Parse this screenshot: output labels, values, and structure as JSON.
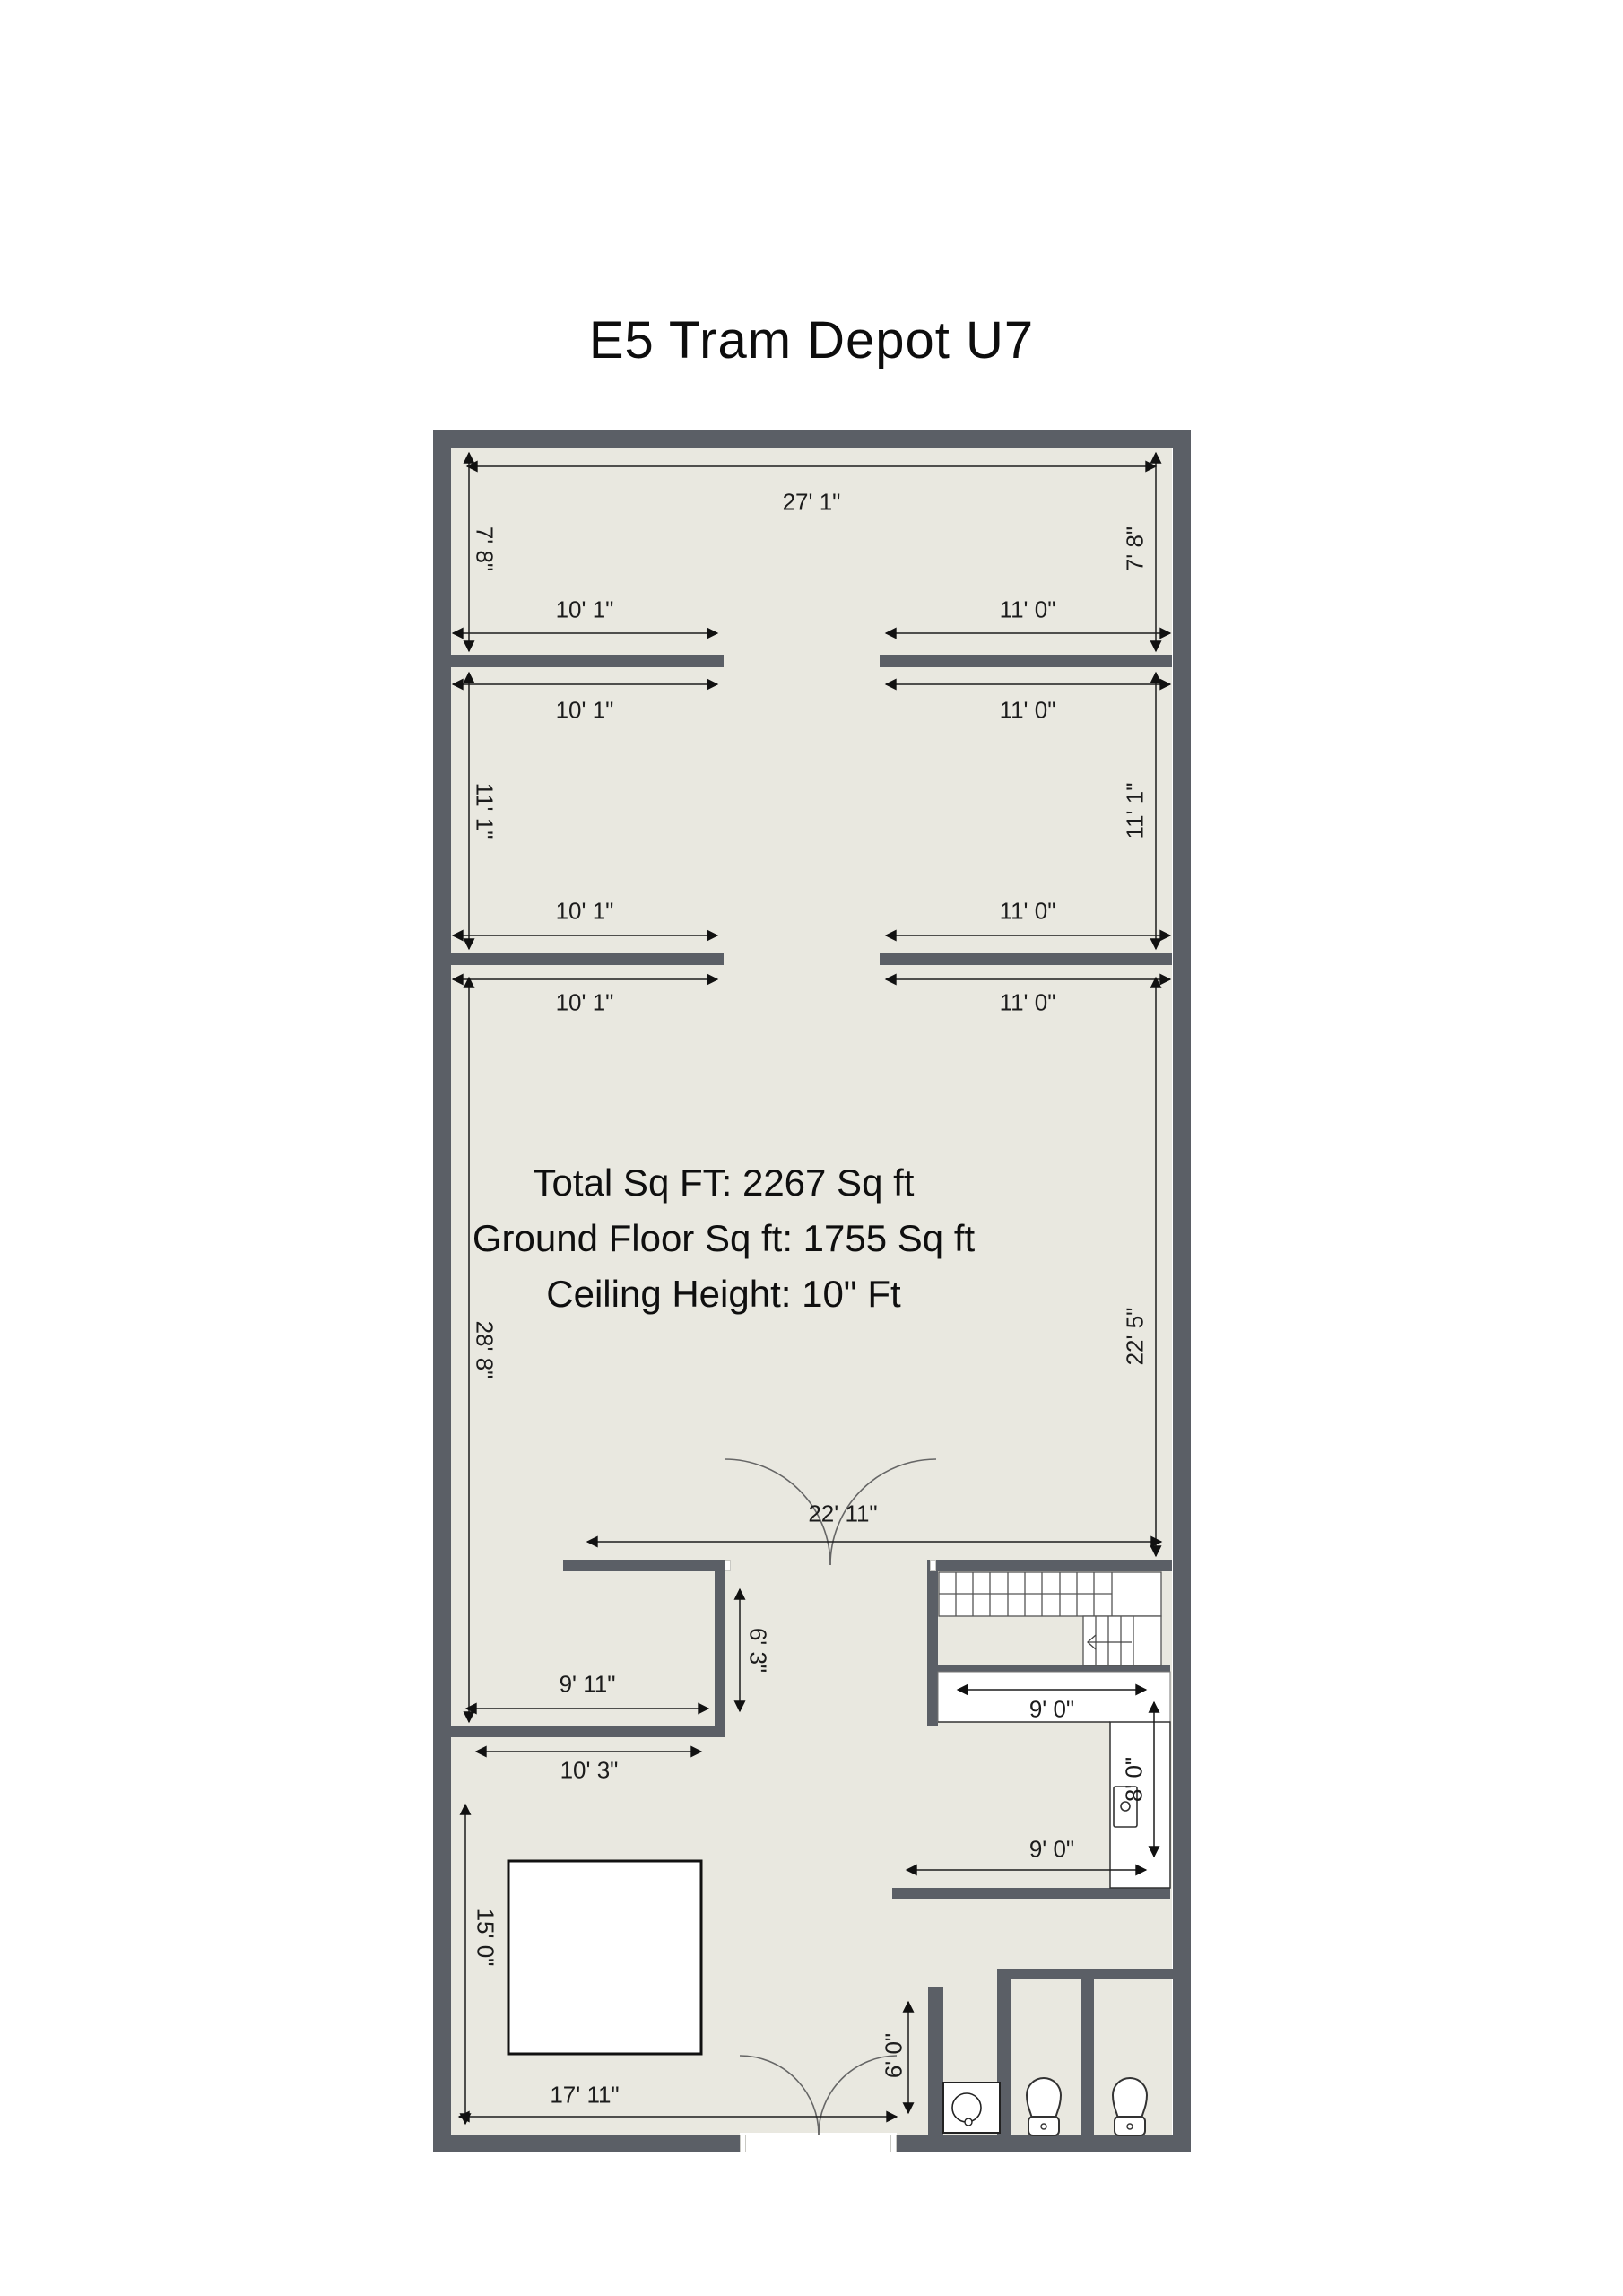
{
  "title": "E5 Tram Depot U7",
  "summary": {
    "total": "Total Sq FT: 2267 Sq ft",
    "ground": "Ground Floor Sq ft: 1755 Sq ft",
    "ceiling": "Ceiling Height: 10\" Ft"
  },
  "dims": {
    "w27_1": "27' 1\"",
    "h7_8_left": "7' 8\"",
    "h7_8_right": "7' 8\"",
    "w10_1_room1": "10' 1\"",
    "w11_0_room1": "11' 0\"",
    "w10_1_room2_top": "10' 1\"",
    "w11_0_room2_top": "11' 0\"",
    "h11_1_left": "11' 1\"",
    "h11_1_right": "11' 1\"",
    "w10_1_room2_bottom": "10' 1\"",
    "w11_0_room2_bottom": "11' 0\"",
    "w10_1_room3": "10' 1\"",
    "w11_0_room3": "11' 0\"",
    "h28_8": "28' 8\"",
    "h22_5": "22' 5\"",
    "w22_11": "22' 11\"",
    "w9_11": "9' 11\"",
    "h6_3": "6' 3\"",
    "w10_3": "10' 3\"",
    "h15_0": "15' 0\"",
    "w17_11": "17' 11\"",
    "w9_0_upper": "9' 0\"",
    "h8_0": "8' 0\"",
    "w9_0_lower": "9' 0\"",
    "h6_0": "6' 0\""
  },
  "colors": {
    "wall": "#5b5f66",
    "floor": "#e9e8e0",
    "dimension": "#1c1c1c",
    "fixture_outline": "#333333",
    "background": "#ffffff"
  }
}
